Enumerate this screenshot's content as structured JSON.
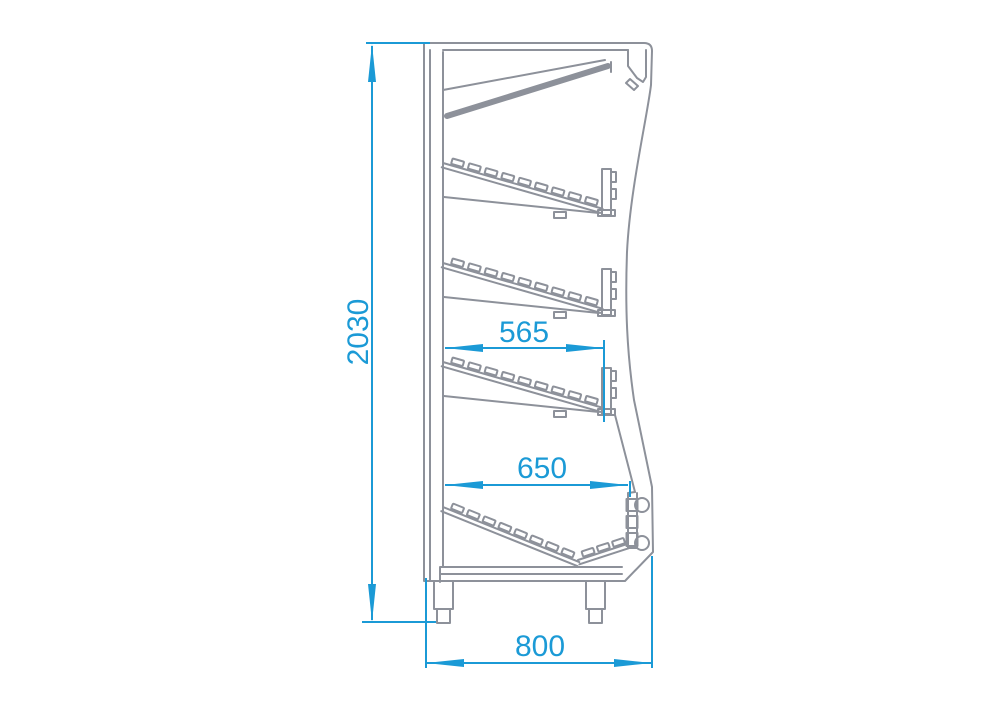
{
  "drawing": {
    "description": "Side cross-section technical drawing of a multideck display cabinet with three sloped shelves, canopy light, base well and legs",
    "colors": {
      "dimension": "#1b9ad6",
      "outline": "#8d919a",
      "background": "#ffffff"
    },
    "dimensions": {
      "overall_height": "2030",
      "shelf_depth": "565",
      "base_shelf_depth": "650",
      "overall_depth": "800"
    }
  }
}
